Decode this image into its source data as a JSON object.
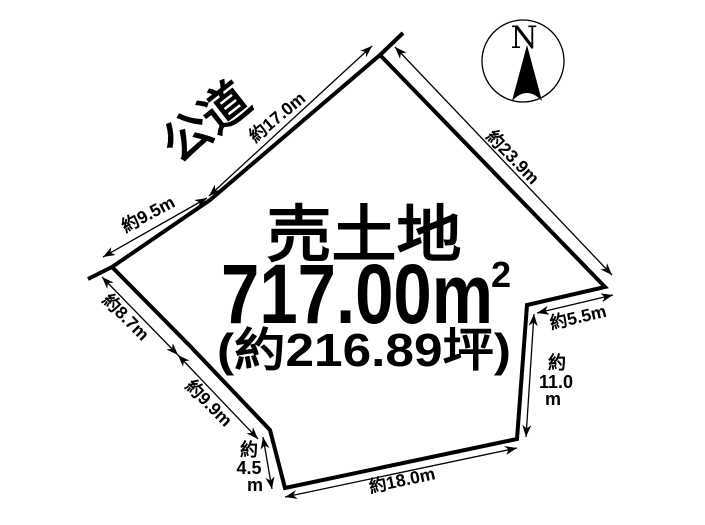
{
  "colors": {
    "ink": "#000000",
    "paper": "#ffffff"
  },
  "diagram": {
    "road_label": {
      "text": "公道",
      "x": 206,
      "y": 122,
      "rot": -38
    },
    "parcel": {
      "vertices": [
        [
          380,
          55
        ],
        [
          605,
          287
        ],
        [
          527,
          305
        ],
        [
          517,
          439
        ],
        [
          285,
          488
        ],
        [
          270,
          430
        ],
        [
          190,
          346
        ],
        [
          112,
          267
        ],
        [
          210,
          200
        ]
      ],
      "overshoots": [
        [
          380,
          55,
          403,
          33
        ],
        [
          112,
          267,
          88,
          279
        ]
      ]
    },
    "center_text": {
      "title": "売土地",
      "area_value": "717.00m",
      "area_sup": "2",
      "area_tsubo": "(約216.89坪)"
    },
    "dimensions": [
      {
        "name": "9-5m",
        "label": "約9.5m",
        "x1": 103,
        "y1": 257,
        "x2": 207,
        "y2": 198,
        "lx": 148,
        "ly": 214,
        "rot": -28
      },
      {
        "name": "17-0m",
        "label": "約17.0m",
        "x1": 209,
        "y1": 196,
        "x2": 372,
        "y2": 46,
        "lx": 277,
        "ly": 117,
        "rot": -40
      },
      {
        "name": "23-9m",
        "label": "約23.9m",
        "x1": 395,
        "y1": 47,
        "x2": 612,
        "y2": 275,
        "lx": 513,
        "ly": 157,
        "rot": 46
      },
      {
        "name": "5-5m",
        "label": "約5.5m",
        "x1": 537,
        "y1": 313,
        "x2": 613,
        "y2": 295,
        "lx": 578,
        "ly": 317,
        "rot": -13
      },
      {
        "name": "11-0m",
        "x1": 534,
        "y1": 314,
        "x2": 526,
        "y2": 437,
        "stack": [
          {
            "t": "約",
            "x": 557,
            "y": 369
          },
          {
            "t": "11.0",
            "x": 556,
            "y": 388
          },
          {
            "t": "m",
            "x": 553,
            "y": 405
          }
        ]
      },
      {
        "name": "18-0m",
        "label": "約18.0m",
        "x1": 285,
        "y1": 497,
        "x2": 517,
        "y2": 448,
        "lx": 402,
        "ly": 480,
        "rot": -12
      },
      {
        "name": "4-5m",
        "x1": 263,
        "y1": 437,
        "x2": 272,
        "y2": 489,
        "stack": [
          {
            "t": "約",
            "x": 249,
            "y": 456
          },
          {
            "t": "4.5",
            "x": 249,
            "y": 474
          },
          {
            "t": "m",
            "x": 255,
            "y": 491
          }
        ]
      },
      {
        "name": "8-7m",
        "label": "約8.7m",
        "x1": 102,
        "y1": 277,
        "x2": 178,
        "y2": 355,
        "lx": 126,
        "ly": 317,
        "rot": 45
      },
      {
        "name": "9-9m",
        "label": "約9.9m",
        "x1": 178,
        "y1": 355,
        "x2": 258,
        "y2": 439,
        "lx": 209,
        "ly": 403,
        "rot": 45
      }
    ],
    "compass": {
      "label": "N",
      "cx": 523,
      "cy": 61,
      "r": 41
    }
  }
}
